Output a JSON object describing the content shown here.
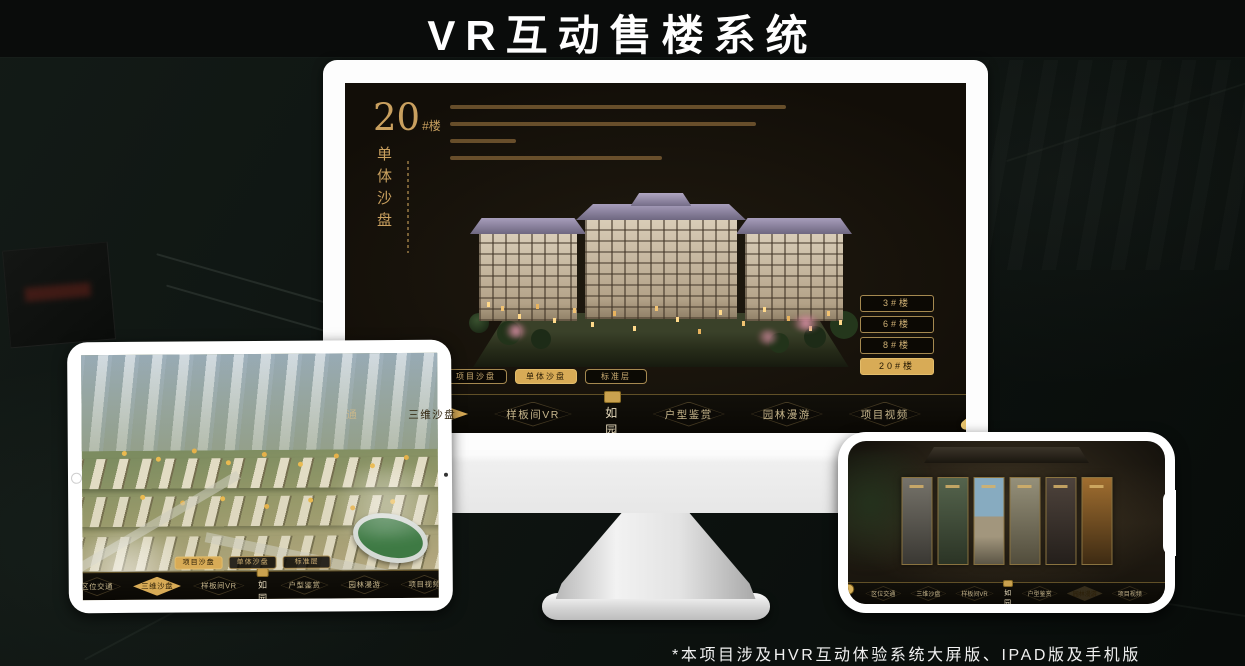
{
  "title": "VR互动售楼系统",
  "footnote": "*本项目涉及HVR互动体验系统大屏版、IPAD版及手机版",
  "colors": {
    "gold": "#c9a05f",
    "gold_active": "#d8ab56",
    "screen_bg": "#17130c",
    "white": "#ffffff"
  },
  "logo": {
    "name": "如园",
    "seal_icon": "gold-seal-icon"
  },
  "nav_items": [
    "区位交通",
    "三维沙盘",
    "样板间VR",
    "户型鉴赏",
    "园林漫游",
    "项目视频"
  ],
  "view_tabs": [
    "项目沙盘",
    "单体沙盘",
    "标准层"
  ],
  "monitor": {
    "unit_number": "20",
    "unit_suffix": "#楼",
    "unit_subtitle": "单体沙盘",
    "floor_buttons": [
      "3#楼",
      "6#楼",
      "8#楼",
      "20#楼"
    ],
    "active_floor": "20#楼",
    "active_view_tab": "单体沙盘",
    "active_nav_item": "三维沙盘"
  },
  "tablet": {
    "active_view_tab": "项目沙盘",
    "active_nav_item": "三维沙盘"
  },
  "phone": {
    "active_nav_item": "园林漫游",
    "gallery_panel_count": 6
  }
}
